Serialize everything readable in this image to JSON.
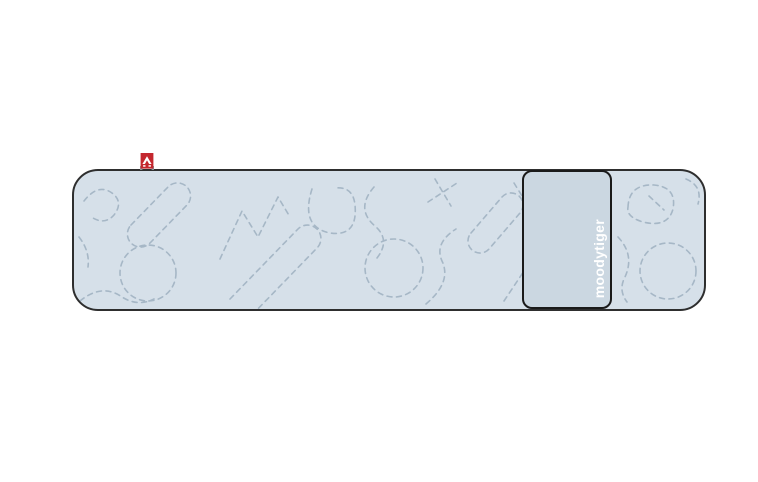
{
  "product": {
    "brand_label": "moodytiger"
  },
  "icons": {
    "tag_logo": "moodytiger-triangle-logo"
  },
  "theme": {
    "page_bg": "#ffffff",
    "body_fill": "#d6e0e9",
    "panel_fill": "#cbd7e1",
    "dash_color": "#a6b7c6",
    "outline_color": "#2e2e2e",
    "panel_outline_color": "#1a1a1a",
    "tag_red": "#c4272e",
    "tag_edge": "#8d949b",
    "brand_text_color": "#ffffff"
  }
}
